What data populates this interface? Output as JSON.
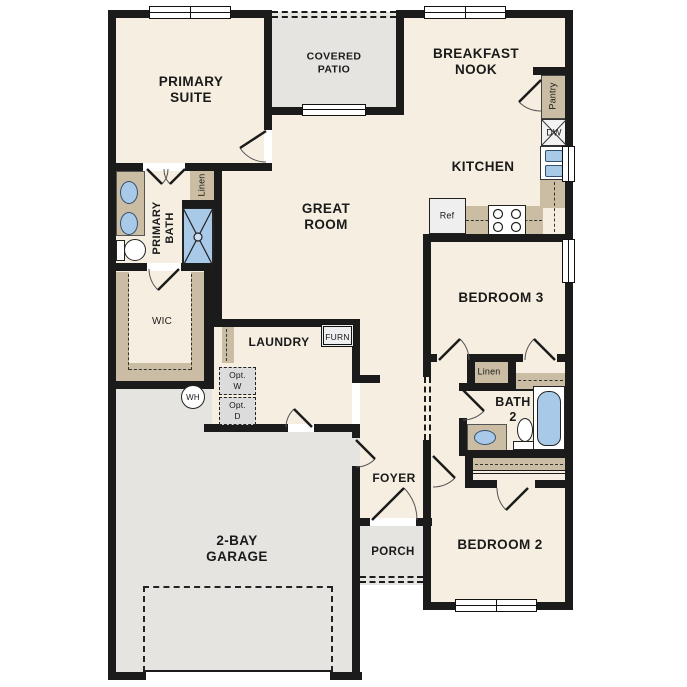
{
  "title": "single-story floor plan",
  "palette": {
    "wall": "#1b1b1b",
    "room_fill": "#f6efe1",
    "outdoor_fill": "#e5e4e1",
    "cabinet_tan": "#cbbda3",
    "fixture_blue": "#a9c9e9",
    "text": "#1a1a1a"
  },
  "rooms": {
    "primary_suite": {
      "line1": "PRIMARY",
      "line2": "SUITE"
    },
    "covered_patio": {
      "line1": "COVERED",
      "line2": "PATIO"
    },
    "breakfast_nook": {
      "line1": "BREAKFAST",
      "line2": "NOOK"
    },
    "kitchen": {
      "label": "KITCHEN"
    },
    "great_room": {
      "line1": "GREAT",
      "line2": "ROOM"
    },
    "primary_bath": {
      "line1": "PRIMARY",
      "line2": "BATH"
    },
    "wic": {
      "label": "WIC"
    },
    "laundry": {
      "label": "LAUNDRY"
    },
    "bedroom3": {
      "label": "BEDROOM 3"
    },
    "bath2": {
      "line1": "BATH",
      "line2": "2"
    },
    "bedroom2": {
      "label": "BEDROOM 2"
    },
    "foyer": {
      "label": "FOYER"
    },
    "porch": {
      "label": "PORCH"
    },
    "garage": {
      "line1": "2-BAY",
      "line2": "GARAGE"
    }
  },
  "features": {
    "linen_upper": "Linen",
    "linen_lower": "Linen",
    "pantry": "Pantry",
    "dishwasher": "DW",
    "refrigerator": "Ref",
    "furnace": "FURN",
    "opt_washer_1": "Opt.",
    "opt_washer_2": "W",
    "opt_dryer_1": "Opt.",
    "opt_dryer_2": "D",
    "water_heater": "WH"
  }
}
